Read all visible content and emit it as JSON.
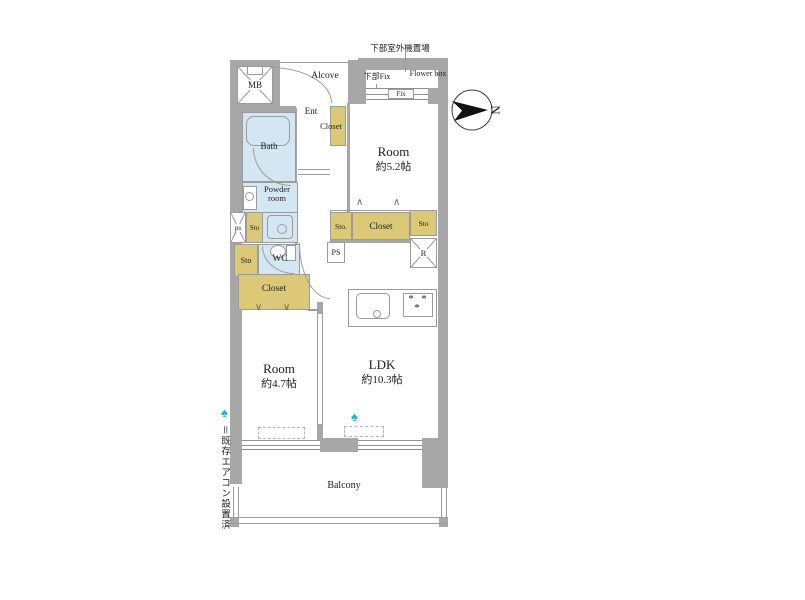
{
  "compass": {
    "letter": "N"
  },
  "legend": {
    "marker_glyph": "♠",
    "text": "＝既存エアコン設置済"
  },
  "notes": {
    "outdoor_unit": "下部室外機置場",
    "lower_fix": "下部Fix",
    "flower_box": "Flower box",
    "fix": "Fix"
  },
  "rooms": {
    "mb": {
      "label": "MB"
    },
    "alcove": {
      "label": "Alcove"
    },
    "entrance": {
      "label": "Ent"
    },
    "entrance_closet": {
      "label": "Closet"
    },
    "bath": {
      "label": "Bath"
    },
    "powder_room": {
      "label": "Powder room"
    },
    "pipe_space_small": {
      "label": "ps"
    },
    "storage_hall_upper": {
      "label": "Sto"
    },
    "storage_hall_lower": {
      "label": "Sto"
    },
    "wc": {
      "label": "WC"
    },
    "closet_west": {
      "label": "Closet"
    },
    "bedroom_north": {
      "label": "Room",
      "size": "約5.2帖"
    },
    "bedroom_south": {
      "label": "Room",
      "size": "約4.7帖"
    },
    "ldk": {
      "label": "LDK",
      "size": "約10.3帖"
    },
    "storage_mid": {
      "label": "Sto."
    },
    "closet_mid": {
      "label": "Closet"
    },
    "storage_east": {
      "label": "Sto"
    },
    "refrigerator": {
      "label": "R"
    },
    "pipe_space": {
      "label": "PS"
    },
    "balcony": {
      "label": "Balcony"
    }
  },
  "icons": {
    "stove_burner_glyph": "*"
  },
  "colors": {
    "wall": "#a7a7a7",
    "wet_area": "#d3e7f3",
    "storage": "#dbc977",
    "ac_marker": "#2aabdf"
  }
}
